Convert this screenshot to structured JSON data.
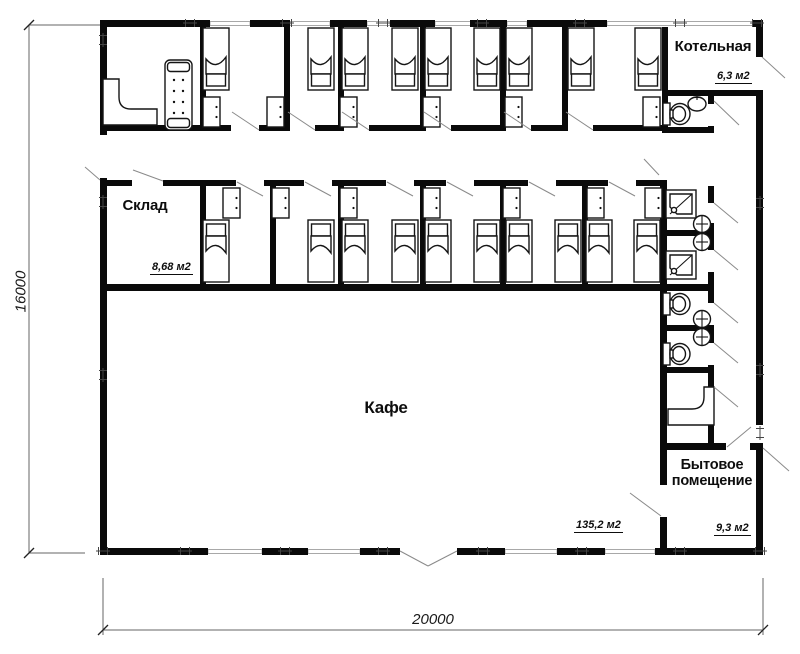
{
  "plan": {
    "rooms": {
      "kotelnaya": {
        "name": "Котельная",
        "area": "6,3 м2"
      },
      "sklad": {
        "name": "Склад",
        "area": "8,68 м2"
      },
      "kafe": {
        "name": "Кафе",
        "area": "135,2 м2"
      },
      "bytovoe": {
        "name": "Бытовое помещение",
        "area": "9,3 м2"
      }
    },
    "dimensions": {
      "overall_width_mm": "20000",
      "overall_height_mm": "16000"
    },
    "colors": {
      "wall": "#0a0a0a",
      "window_line": "#a8a8a8",
      "annotation_line": "#8a8a8a",
      "text": "#111111"
    }
  }
}
